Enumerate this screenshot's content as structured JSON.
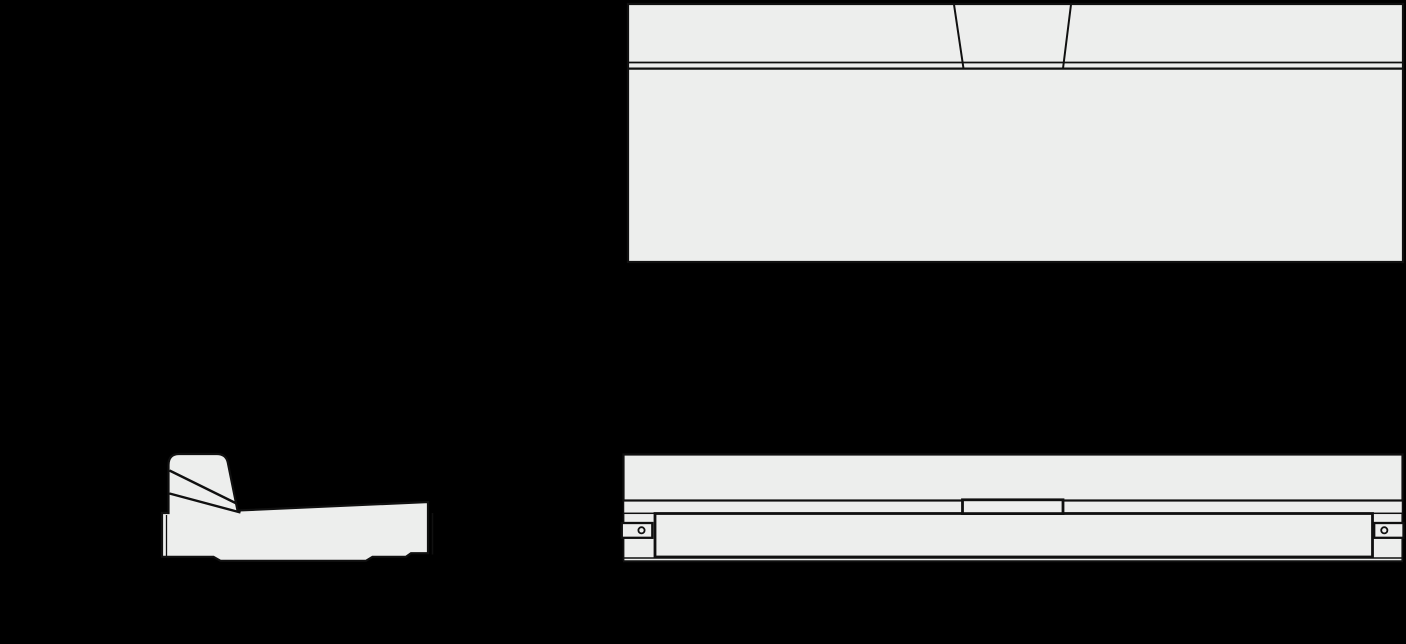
{
  "document": {
    "type": "technical-orthographic-line-drawing",
    "subject": "bed frame with tilted headboard",
    "views": [
      {
        "id": "plan",
        "label": "bed top (plan) view"
      },
      {
        "id": "side",
        "label": "bed side view"
      },
      {
        "id": "front",
        "label": "bed front view"
      }
    ]
  },
  "colors": {
    "background": "#000000",
    "part_fill": "#edeeed",
    "line": "#101010"
  }
}
